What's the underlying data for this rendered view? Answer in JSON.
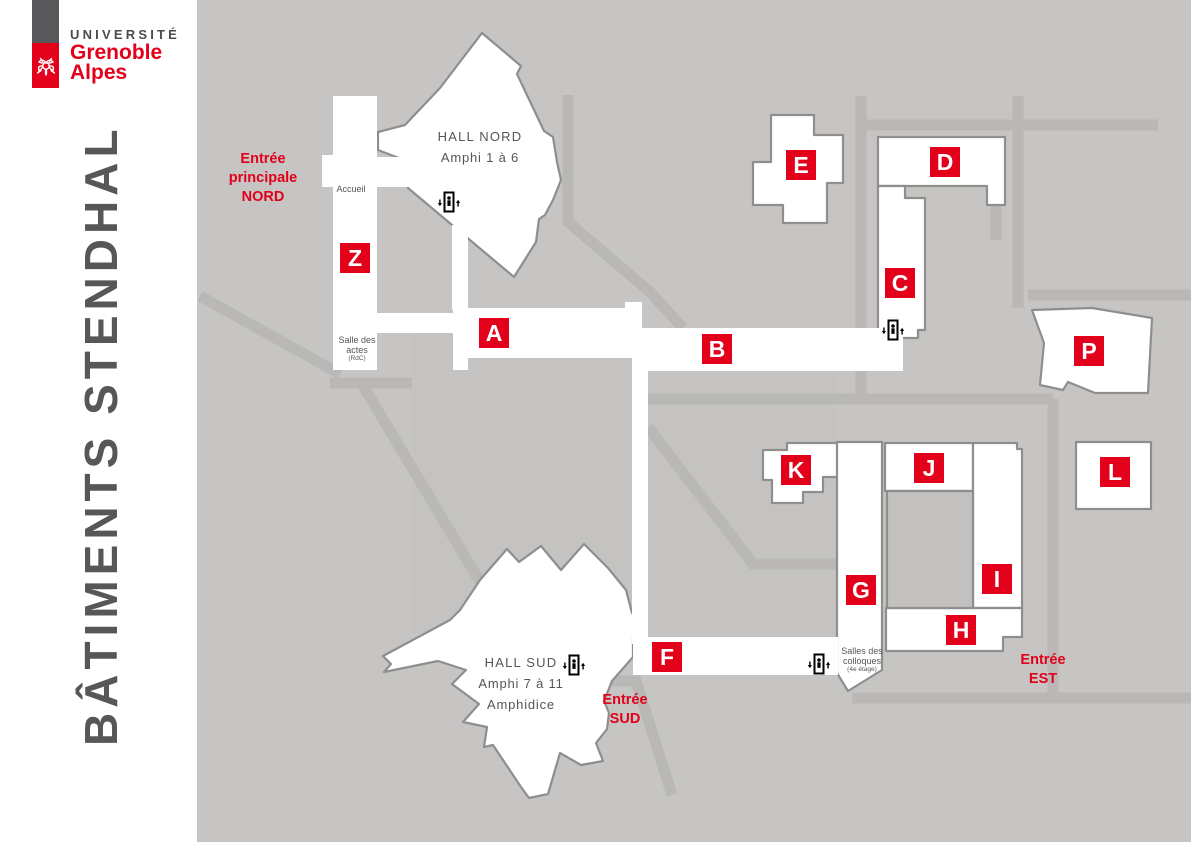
{
  "sidebar": {
    "logo": {
      "university_line": "UNIVERSITÉ",
      "brand_line1": "Grenoble",
      "brand_line2": "Alpes",
      "flower_icon": "uga-flower-icon"
    },
    "vertical_title": "BÂTIMENTS STENDHAL"
  },
  "map": {
    "colors": {
      "background": "#c6c5c3",
      "inner_area": "#c4c3c1",
      "pathway": "#b9b8b6",
      "building_fill": "#ffffff",
      "building_stroke": "#8f8e8d",
      "courtyard": "#c2c1bf",
      "accent_red": "#e2001a",
      "label_gray": "#565655"
    },
    "buildings": [
      {
        "label": "Z",
        "x": 340,
        "y": 243
      },
      {
        "label": "A",
        "x": 479,
        "y": 318
      },
      {
        "label": "B",
        "x": 702,
        "y": 334
      },
      {
        "label": "C",
        "x": 885,
        "y": 268
      },
      {
        "label": "D",
        "x": 930,
        "y": 147
      },
      {
        "label": "E",
        "x": 786,
        "y": 150
      },
      {
        "label": "F",
        "x": 652,
        "y": 642
      },
      {
        "label": "G",
        "x": 846,
        "y": 575
      },
      {
        "label": "H",
        "x": 946,
        "y": 615
      },
      {
        "label": "I",
        "x": 982,
        "y": 564
      },
      {
        "label": "J",
        "x": 914,
        "y": 453
      },
      {
        "label": "K",
        "x": 781,
        "y": 455
      },
      {
        "label": "L",
        "x": 1100,
        "y": 457
      },
      {
        "label": "P",
        "x": 1074,
        "y": 336
      }
    ],
    "halls": [
      {
        "name": "HALL NORD",
        "subs": [
          "Amphi 1 à 6"
        ],
        "x": 480,
        "y": 126
      },
      {
        "name": "HALL SUD",
        "subs": [
          "Amphi 7 à 11",
          "Amphidice"
        ],
        "x": 521,
        "y": 652
      }
    ],
    "entrances": [
      {
        "lines": [
          "Entrée",
          "principale",
          "NORD"
        ],
        "x": 263,
        "y": 150
      },
      {
        "lines": [
          "Entrée",
          "SUD"
        ],
        "x": 625,
        "y": 691
      },
      {
        "lines": [
          "Entrée",
          "EST"
        ],
        "x": 1043,
        "y": 651
      }
    ],
    "rooms": [
      {
        "lines": [
          "Accueil"
        ],
        "note": "",
        "x": 351,
        "y": 184
      },
      {
        "lines": [
          "Salle des",
          "actes"
        ],
        "note": "(RdC)",
        "x": 357,
        "y": 335
      },
      {
        "lines": [
          "Salles des",
          "colloques"
        ],
        "note": "(4e étage)",
        "x": 862,
        "y": 646
      }
    ],
    "elevators": [
      {
        "x": 449,
        "y": 203
      },
      {
        "x": 893,
        "y": 331
      },
      {
        "x": 574,
        "y": 666
      },
      {
        "x": 819,
        "y": 665
      }
    ]
  }
}
